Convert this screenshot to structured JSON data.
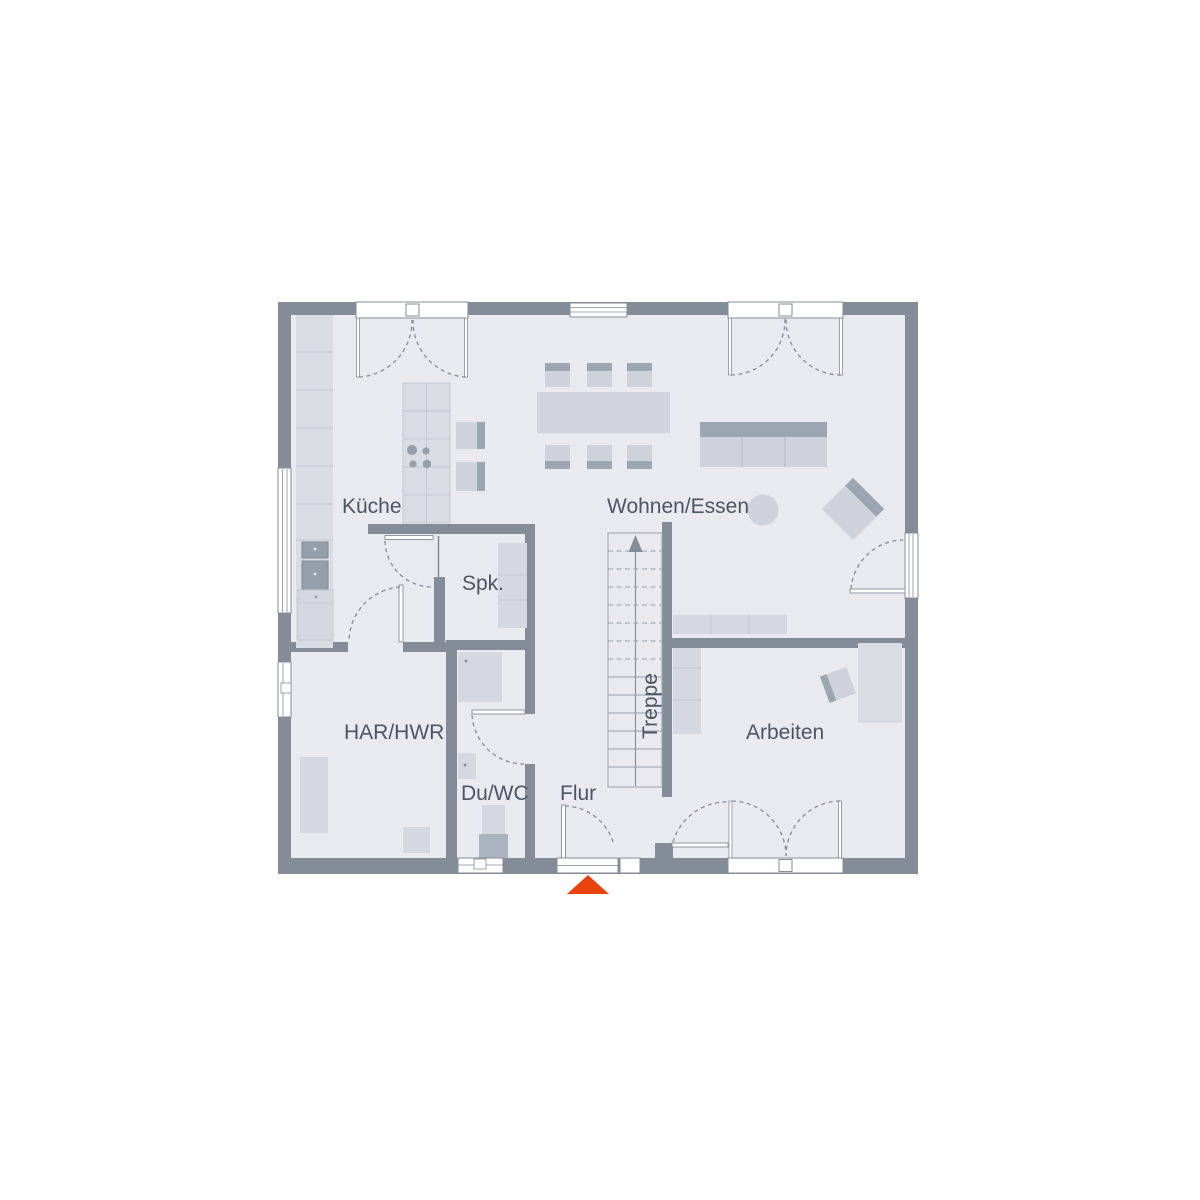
{
  "plan": {
    "type": "floorplan",
    "floor_labels": {
      "kueche": "Küche",
      "wohnen_essen": "Wohnen/Essen",
      "spk": "Spk.",
      "har_hwr": "HAR/HWR",
      "du_wc": "Du/WC",
      "flur": "Flur",
      "treppe": "Treppe",
      "arbeiten": "Arbeiten"
    },
    "icons": {
      "entrance_marker": "triangle-up",
      "stairs_direction": "arrow-up"
    },
    "colors": {
      "wall": "#848C9A",
      "floor": "#E8EAEF",
      "line": "#8A92A0",
      "furniture_light": "#D4D8E0",
      "furniture_mid": "#CDD2DB",
      "furniture_band": "#9CA5B2",
      "appliance": "#959EAB",
      "label_text": "#4C5562",
      "entrance_accent": "#E8420D",
      "background": "#FFFFFF"
    }
  }
}
